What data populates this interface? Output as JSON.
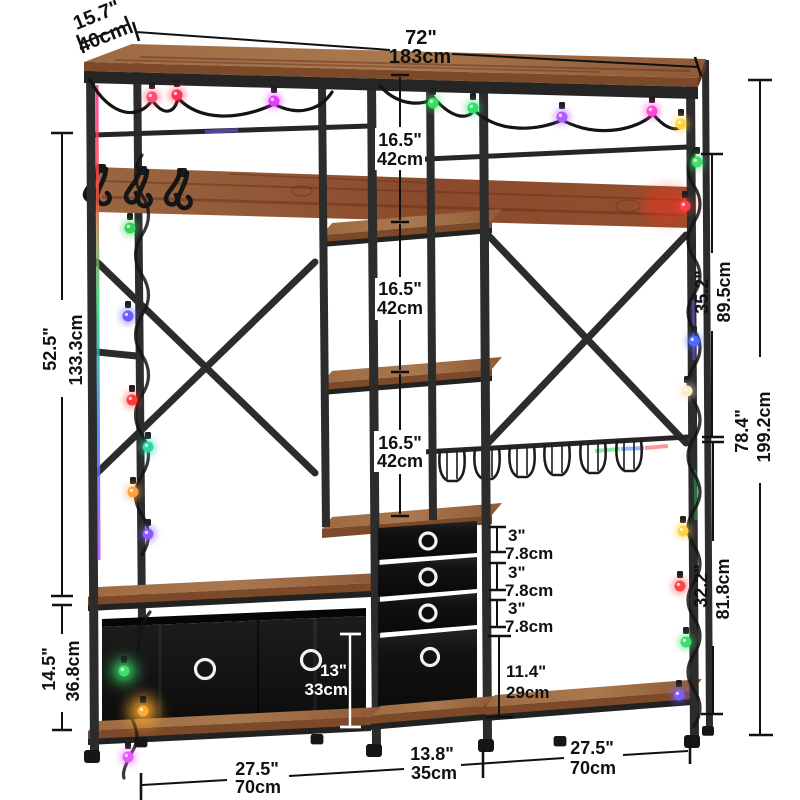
{
  "dims": {
    "depth": {
      "in": "15.7\"",
      "cm": "40cm"
    },
    "width": {
      "in": "72\"",
      "cm": "183cm"
    },
    "left_upper": {
      "in": "52.5\"",
      "cm": "133.3cm"
    },
    "left_lower": {
      "in": "14.5\"",
      "cm": "36.8cm"
    },
    "right_upper": {
      "in": "35.2\"",
      "cm": "89.5cm"
    },
    "right_lower": {
      "in": "32.2\"",
      "cm": "81.8cm"
    },
    "overall_height": {
      "in": "78.4\"",
      "cm": "199.2cm"
    },
    "shelf_gap_1": {
      "in": "16.5\"",
      "cm": "42cm"
    },
    "shelf_gap_2": {
      "in": "16.5\"",
      "cm": "42cm"
    },
    "shelf_gap_3": {
      "in": "16.5\"",
      "cm": "42cm"
    },
    "drawer_1": {
      "in": "3\"",
      "cm": "7.8cm"
    },
    "drawer_2": {
      "in": "3\"",
      "cm": "7.8cm"
    },
    "drawer_3": {
      "in": "3\"",
      "cm": "7.8cm"
    },
    "drawer_large": {
      "in": "11.4\"",
      "cm": "29cm"
    },
    "bin_height": {
      "in": "13\"",
      "cm": "33cm"
    },
    "base_left": {
      "in": "27.5\"",
      "cm": "70cm"
    },
    "base_center": {
      "in": "13.8\"",
      "cm": "35cm"
    },
    "base_right": {
      "in": "27.5\"",
      "cm": "70cm"
    }
  },
  "illustration": {
    "parts": [
      "wood-top-shelf",
      "metal-frame",
      "wood-back-panel",
      "coat-hooks",
      "hanging-rod-left",
      "hanging-rod-right",
      "x-brace-left",
      "x-brace-right",
      "wine-glass-rack",
      "middle-tower-shelves",
      "fabric-drawers",
      "storage-bin",
      "bottom-shelves",
      "string-lights",
      "feet"
    ],
    "string_light_colors": [
      "#ff4d6d",
      "#ff3355",
      "#e43cff",
      "#35e05a",
      "#2ee06e",
      "#b05cff",
      "#ff49d6",
      "#ffd23e",
      "#6a5cff",
      "#ff3b3b",
      "#2fd6a8",
      "#ffa23e",
      "#8a5cff",
      "#4d6aff",
      "#ffe9c9",
      "#3de06a",
      "#ff4545",
      "#7a5cff",
      "#e45cff",
      "#ffaa2e"
    ]
  },
  "style": {
    "dimension_color": "#111111",
    "dimension_color_on_dark": "#ffffff",
    "metal_color": "#2c2c2c",
    "wood_color": "#9a6742",
    "wood_dark": "#8a4a2c",
    "fabric_color": "#141414",
    "background": "#ffffff"
  }
}
